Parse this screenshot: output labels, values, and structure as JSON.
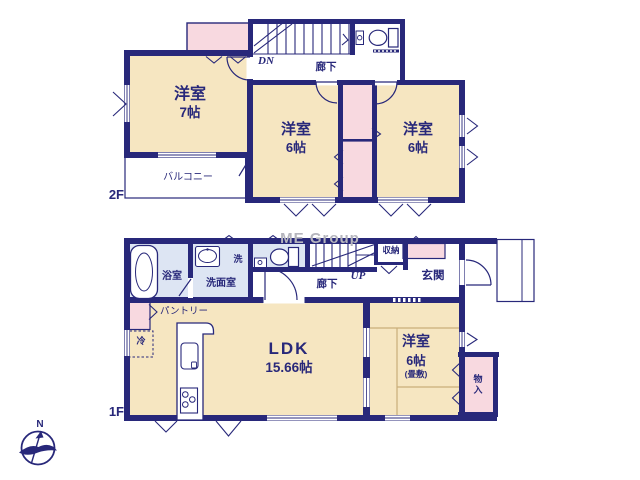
{
  "watermark": "ME Group",
  "compass": {
    "north_label": "N"
  },
  "colors": {
    "wall_navy": "#28287a",
    "room_cream": "#f6e6c1",
    "closet_pink": "#f8d9e0",
    "wet_area_blue": "#dde5f3",
    "watermark_gray": "#b5b5bd"
  },
  "second_floor": {
    "floor_label": "2F",
    "stairs_label": "DN",
    "hallway_label": "廊下",
    "balcony_label": "バルコニー",
    "rooms": {
      "west": {
        "name": "洋室",
        "size": "7帖"
      },
      "center": {
        "name": "洋室",
        "size": "6帖"
      },
      "east": {
        "name": "洋室",
        "size": "6帖"
      }
    }
  },
  "first_floor": {
    "floor_label": "1F",
    "stairs_label": "UP",
    "hallway_label": "廊下",
    "entrance_label": "玄関",
    "storage_label": "収納",
    "bath_label": "浴室",
    "washroom_label": "洗面室",
    "laundry_label": "洗",
    "pantry_label": "パントリー",
    "fridge_label": "冷",
    "closet_label": "物入",
    "ldk": {
      "name": "LDK",
      "size": "15.66帖"
    },
    "tatami_room": {
      "name": "洋室",
      "size": "6帖",
      "note": "(畳敷)"
    }
  }
}
